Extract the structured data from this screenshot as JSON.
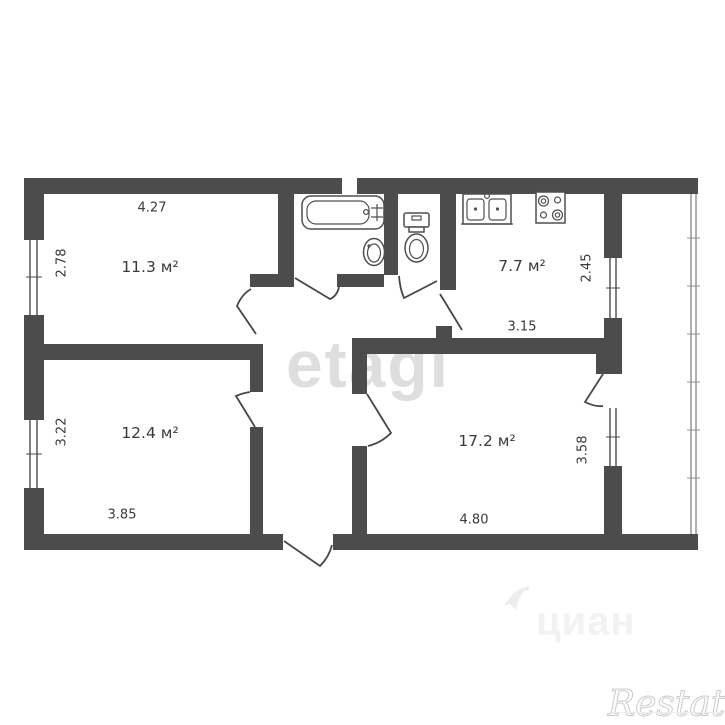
{
  "floor_plan": {
    "rooms": [
      {
        "name": "bedroom-top-left",
        "label": "11.3 м²",
        "dims": {
          "top": "4.27",
          "left": "2.78"
        }
      },
      {
        "name": "kitchen",
        "label": "7.7 м²",
        "dims": {
          "bottom": "3.15",
          "right": "2.45"
        }
      },
      {
        "name": "bedroom-bottom-left",
        "label": "12.4 м²",
        "dims": {
          "bottom": "3.85",
          "left": "3.22"
        }
      },
      {
        "name": "living-room",
        "label": "17.2 м²",
        "dims": {
          "bottom": "4.80",
          "right": "3.58"
        }
      }
    ],
    "fixtures": [
      "bathtub",
      "washbasin",
      "toilet",
      "kitchen-sink",
      "stove"
    ],
    "features": [
      "balcony",
      "entrance-door",
      "interior-doors",
      "windows"
    ]
  },
  "watermarks": {
    "center": "etagi",
    "bottom": "циан",
    "bottom_right": "Restate"
  },
  "colors": {
    "background": "#ffffff",
    "walls": "#4c4c4c",
    "fixture_outline": "#4f4f4f",
    "door_line": "#474747",
    "glazing": "#8f8f8f",
    "labels": "#3a3a3a",
    "watermark_etagi": "#dedede",
    "watermark_cian": "#f2f2f2",
    "watermark_restate": "#cccccc"
  }
}
